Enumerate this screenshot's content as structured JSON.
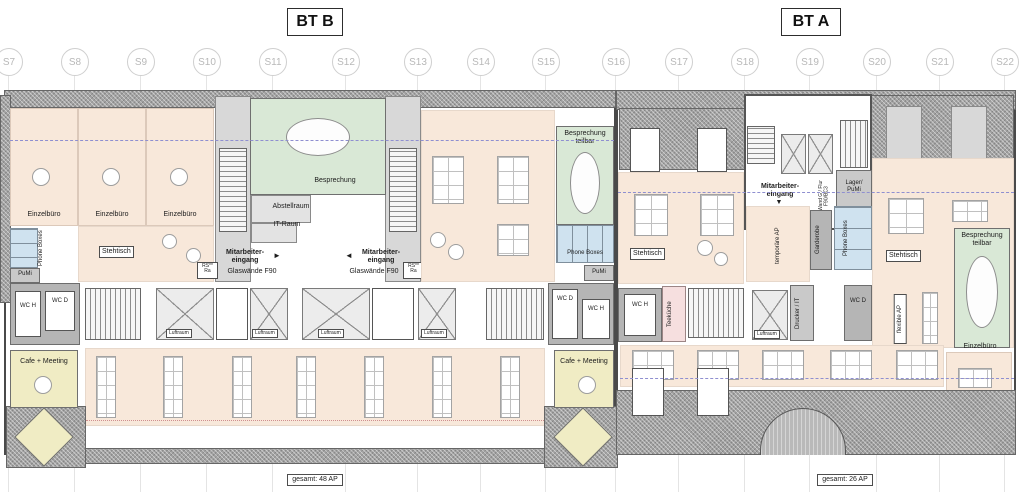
{
  "header": {
    "bt_b": "BT B",
    "bt_a": "BT A"
  },
  "grid_labels": [
    "S7",
    "S8",
    "S9",
    "S10",
    "S11",
    "S12",
    "S13",
    "S14",
    "S15",
    "S16",
    "S17",
    "S18",
    "S19",
    "S20",
    "S21",
    "S22"
  ],
  "labels": {
    "einzelbuero": "Einzelbüro",
    "phone_boxes": "Phone Boxes",
    "pumi": "PuMi",
    "stehtisch": "Stehtisch",
    "besprechung": "Besprechung",
    "besprechung_teilbar": "Besprechung teilbar",
    "abstellraum": "Abstellraum",
    "it_raum": "IT-Raum",
    "mitarbeiter_eingang": "Mitarbeiter- eingang",
    "glaswaende": "Glaswände F90",
    "rs_ra": "RS** Ra",
    "wc_h": "WC H",
    "wc_d": "WC D",
    "luftraum": "Luftraum",
    "cafe_meeting": "Cafe + Meeting",
    "teekueche": "Teeküche",
    "wand_flur": "Wand G / Flur F90/BC3",
    "lager_pumi": "Lager/ PuMi",
    "temporaere_ap": "temporäre AP",
    "garderobe": "Garderobe",
    "drucker_it": "Drucker / IT",
    "flexible_ap": "flexible AP"
  },
  "icons": {
    "arrow_right": "►",
    "arrow_left": "◄",
    "arrow_down": "▼"
  },
  "totals": {
    "bt_b": "gesamt: 48 AP",
    "bt_a": "gesamt: 26 AP"
  },
  "colors": {
    "office": "#f8e8da",
    "meeting_room": "#d9e8d6",
    "phone_box": "#cfe2ef",
    "cafe": "#f0ecc4",
    "teekueche": "#f6dfdf",
    "wall": "#8f8f8f",
    "roof_hatch": "#a2a2a2",
    "grid": "#cfcfcf",
    "escape_line": "#8f8fd0"
  }
}
